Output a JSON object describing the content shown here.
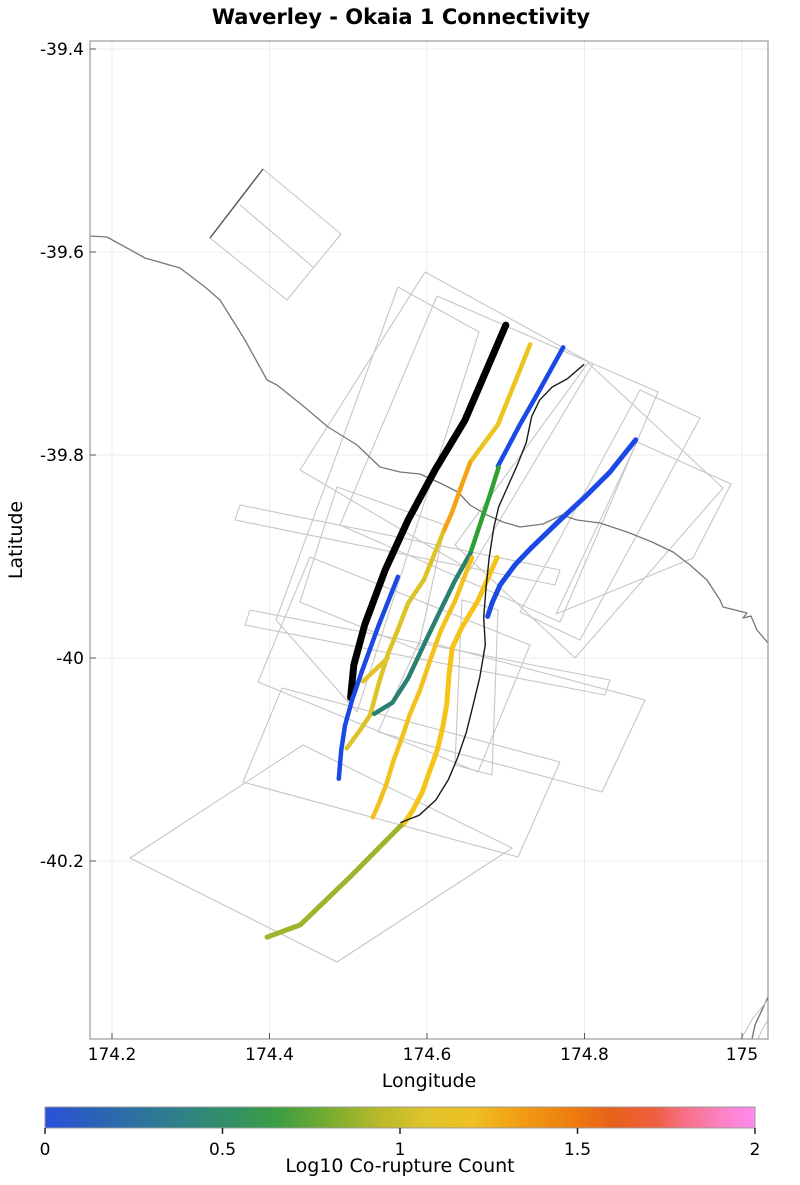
{
  "title": "Waverley - Okaia 1 Connectivity",
  "axes": {
    "x": {
      "label": "Longitude",
      "ticks": [
        {
          "label": "174.2",
          "lon": 174.2
        },
        {
          "label": "174.4",
          "lon": 174.4
        },
        {
          "label": "174.6",
          "lon": 174.6
        },
        {
          "label": "174.8",
          "lon": 174.8
        },
        {
          "label": "175",
          "lon": 175.0
        }
      ]
    },
    "y": {
      "label": "Latitude",
      "ticks": [
        {
          "label": "-39.4",
          "lat": -39.4
        },
        {
          "label": "-39.6",
          "lat": -39.6
        },
        {
          "label": "-39.8",
          "lat": -39.8
        },
        {
          "label": "-40",
          "lat": -40.0
        },
        {
          "label": "-40.2",
          "lat": -40.2
        }
      ]
    },
    "proj": {
      "lon0": 174.2,
      "x0": 112,
      "px_per_lon": 787.5,
      "lat0": -39.4,
      "y0": 49,
      "px_per_lat": 1015
    },
    "plot_box_px": {
      "left": 90,
      "top": 41,
      "right": 768,
      "bottom": 1039
    },
    "grid_color": "#ececec",
    "border_color": "#999999"
  },
  "colorbar": {
    "label": "Log10 Co-rupture Count",
    "bar_px": {
      "x": 45,
      "y": 1107,
      "w": 710,
      "h": 21
    },
    "ticks": [
      {
        "label": "0",
        "frac": 0
      },
      {
        "label": "0.5",
        "frac": 0.25
      },
      {
        "label": "1",
        "frac": 0.5
      },
      {
        "label": "1.5",
        "frac": 0.75
      },
      {
        "label": "2",
        "frac": 1
      }
    ],
    "stops": [
      [
        0,
        "#2b51dc"
      ],
      [
        0.06,
        "#2a5fbc"
      ],
      [
        0.13,
        "#2d72a0"
      ],
      [
        0.2,
        "#2f8384"
      ],
      [
        0.27,
        "#329261"
      ],
      [
        0.33,
        "#3e9e42"
      ],
      [
        0.4,
        "#77ac2f"
      ],
      [
        0.47,
        "#b8b92b"
      ],
      [
        0.54,
        "#e0c42b"
      ],
      [
        0.6,
        "#eec124"
      ],
      [
        0.67,
        "#f19d12"
      ],
      [
        0.74,
        "#ee7d0f"
      ],
      [
        0.8,
        "#e8611a"
      ],
      [
        0.86,
        "#ee5f41"
      ],
      [
        0.9,
        "#f76f85"
      ],
      [
        0.95,
        "#fc81c1"
      ],
      [
        1,
        "#fe8cf0"
      ]
    ]
  },
  "chart_data": {
    "type": "line",
    "subtype": "geographic fault connectivity map",
    "title": "Waverley - Okaia 1 Connectivity",
    "xlabel": "Longitude",
    "ylabel": "Latitude",
    "xlim": [
      174.172,
      175.042
    ],
    "ylim": [
      -40.375,
      -39.391
    ],
    "grid": true,
    "legend": "horizontal colorbar, Log10 Co-rupture Count, range 0 to 2",
    "traces": [
      {
        "name": "main-fault-black",
        "color": "#000000",
        "width": 7,
        "log10_est": null,
        "points": [
          [
            174.7,
            -39.672
          ],
          [
            174.648,
            -39.766
          ],
          [
            174.61,
            -39.815
          ],
          [
            174.576,
            -39.864
          ],
          [
            174.547,
            -39.913
          ],
          [
            174.521,
            -39.967
          ],
          [
            174.507,
            -40.007
          ],
          [
            174.503,
            -40.039
          ]
        ]
      },
      {
        "name": "gold-upper",
        "color": "#ecc41e",
        "width": 4.5,
        "log10_est": 0.9,
        "points": [
          [
            174.731,
            -39.691
          ],
          [
            174.69,
            -39.77
          ],
          [
            174.655,
            -39.807
          ]
        ]
      },
      {
        "name": "orange-mid",
        "color": "#f4a315",
        "width": 4.5,
        "log10_est": 1.15,
        "points": [
          [
            174.655,
            -39.807
          ],
          [
            174.642,
            -39.834
          ],
          [
            174.632,
            -39.856
          ],
          [
            174.62,
            -39.877
          ]
        ]
      },
      {
        "name": "yellow-lower",
        "color": "#ddc228",
        "width": 4.5,
        "log10_est": 0.85,
        "points": [
          [
            174.62,
            -39.877
          ],
          [
            174.596,
            -39.923
          ],
          [
            174.576,
            -39.946
          ],
          [
            174.563,
            -39.972
          ],
          [
            174.55,
            -39.997
          ],
          [
            174.538,
            -40.027
          ],
          [
            174.528,
            -40.056
          ],
          [
            174.515,
            -40.071
          ],
          [
            174.498,
            -40.089
          ]
        ]
      },
      {
        "name": "blue-northeast",
        "color": "#1a49e6",
        "width": 4.5,
        "log10_est": 0.0,
        "points": [
          [
            174.773,
            -39.694
          ],
          [
            174.743,
            -39.736
          ],
          [
            174.718,
            -39.77
          ],
          [
            174.703,
            -39.792
          ],
          [
            174.69,
            -39.811
          ]
        ]
      },
      {
        "name": "green-mid",
        "color": "#2fa032",
        "width": 4.5,
        "log10_est": 0.45,
        "points": [
          [
            174.691,
            -39.812
          ],
          [
            174.68,
            -39.839
          ],
          [
            174.667,
            -39.869
          ],
          [
            174.655,
            -39.897
          ]
        ]
      },
      {
        "name": "teal-mid",
        "color": "#2a8070",
        "width": 4.5,
        "log10_est": 0.25,
        "points": [
          [
            174.655,
            -39.897
          ],
          [
            174.636,
            -39.923
          ],
          [
            174.614,
            -39.958
          ],
          [
            174.596,
            -39.987
          ],
          [
            174.576,
            -40.02
          ],
          [
            174.556,
            -40.044
          ],
          [
            174.533,
            -40.055
          ]
        ]
      },
      {
        "name": "blue-east",
        "color": "#1a49e6",
        "width": 5,
        "log10_est": 0.0,
        "points": [
          [
            174.865,
            -39.785
          ],
          [
            174.832,
            -39.817
          ],
          [
            174.801,
            -39.841
          ],
          [
            174.769,
            -39.864
          ],
          [
            174.733,
            -39.891
          ],
          [
            174.712,
            -39.908
          ],
          [
            174.693,
            -39.928
          ],
          [
            174.683,
            -39.945
          ],
          [
            174.677,
            -39.959
          ]
        ]
      },
      {
        "name": "blue-southwest",
        "color": "#1a49e6",
        "width": 4.5,
        "log10_est": 0.0,
        "points": [
          [
            174.563,
            -39.92
          ],
          [
            174.538,
            -39.969
          ],
          [
            174.517,
            -40.014
          ],
          [
            174.505,
            -40.041
          ],
          [
            174.496,
            -40.066
          ],
          [
            174.491,
            -40.091
          ],
          [
            174.488,
            -40.119
          ]
        ]
      },
      {
        "name": "yellow-short-dash",
        "color": "#e2c32a",
        "width": 4.5,
        "log10_est": 0.85,
        "points": [
          [
            174.55,
            -40.0
          ],
          [
            174.519,
            -40.023
          ]
        ]
      },
      {
        "name": "yellow-central",
        "color": "#f2c11c",
        "width": 4.5,
        "log10_est": 0.9,
        "points": [
          [
            174.657,
            -39.901
          ],
          [
            174.636,
            -39.943
          ],
          [
            174.617,
            -39.974
          ],
          [
            174.604,
            -40.002
          ],
          [
            174.591,
            -40.032
          ],
          [
            174.578,
            -40.056
          ],
          [
            174.568,
            -40.079
          ],
          [
            174.558,
            -40.1
          ],
          [
            174.548,
            -40.125
          ],
          [
            174.538,
            -40.145
          ],
          [
            174.531,
            -40.157
          ]
        ]
      },
      {
        "name": "yellow-east-long",
        "color": "#f6c318",
        "width": 5,
        "log10_est": 0.9,
        "points": [
          [
            174.689,
            -39.901
          ],
          [
            174.665,
            -39.943
          ],
          [
            174.644,
            -39.97
          ],
          [
            174.632,
            -39.99
          ],
          [
            174.628,
            -40.017
          ],
          [
            174.625,
            -40.046
          ],
          [
            174.62,
            -40.068
          ],
          [
            174.613,
            -40.091
          ],
          [
            174.604,
            -40.11
          ],
          [
            174.594,
            -40.132
          ],
          [
            174.582,
            -40.15
          ],
          [
            174.57,
            -40.164
          ]
        ]
      },
      {
        "name": "olive-southwest-diagonal",
        "color": "#9fb32c",
        "width": 5,
        "log10_est": 0.65,
        "points": [
          [
            174.567,
            -40.165
          ],
          [
            174.502,
            -40.216
          ],
          [
            174.439,
            -40.263
          ],
          [
            174.397,
            -40.275
          ]
        ]
      },
      {
        "name": "thin-black-fault",
        "color": "#1a1a1a",
        "width": 1.4,
        "log10_est": null,
        "points": [
          [
            174.799,
            -39.711
          ],
          [
            174.778,
            -39.725
          ],
          [
            174.759,
            -39.733
          ],
          [
            174.743,
            -39.746
          ],
          [
            174.733,
            -39.762
          ],
          [
            174.726,
            -39.788
          ],
          [
            174.714,
            -39.811
          ],
          [
            174.702,
            -39.832
          ],
          [
            174.691,
            -39.851
          ],
          [
            174.685,
            -39.871
          ],
          [
            174.679,
            -39.901
          ],
          [
            174.675,
            -39.93
          ],
          [
            174.672,
            -39.96
          ],
          [
            174.674,
            -39.987
          ],
          [
            174.667,
            -40.019
          ],
          [
            174.658,
            -40.048
          ],
          [
            174.65,
            -40.073
          ],
          [
            174.639,
            -40.098
          ],
          [
            174.627,
            -40.12
          ],
          [
            174.611,
            -40.14
          ],
          [
            174.59,
            -40.155
          ],
          [
            174.567,
            -40.162
          ]
        ]
      }
    ],
    "basemap": {
      "outline_color": "#c6c6c6",
      "coast_color": "#777777",
      "coastline_px": [
        [
          90,
          236
        ],
        [
          107,
          237
        ],
        [
          145,
          258
        ],
        [
          180,
          268
        ],
        [
          205,
          287
        ],
        [
          220,
          300
        ],
        [
          245,
          340
        ],
        [
          267,
          380
        ],
        [
          277,
          385
        ],
        [
          302,
          405
        ],
        [
          328,
          427
        ],
        [
          357,
          445
        ],
        [
          380,
          467
        ],
        [
          400,
          472
        ],
        [
          420,
          474
        ],
        [
          440,
          483
        ],
        [
          458,
          492
        ],
        [
          470,
          505
        ],
        [
          487,
          515
        ],
        [
          503,
          522
        ],
        [
          520,
          527
        ],
        [
          543,
          524
        ],
        [
          562,
          515
        ],
        [
          577,
          520
        ],
        [
          600,
          523
        ],
        [
          627,
          532
        ],
        [
          652,
          542
        ],
        [
          673,
          552
        ],
        [
          690,
          565
        ],
        [
          707,
          580
        ],
        [
          720,
          600
        ],
        [
          723,
          607
        ],
        [
          747,
          613
        ],
        [
          743,
          618
        ],
        [
          751,
          616
        ],
        [
          757,
          630
        ],
        [
          768,
          643
        ]
      ],
      "fault_outline_polygons_px": [
        [
          [
            263,
            169
          ],
          [
            341,
            234
          ],
          [
            287,
            300
          ],
          [
            210,
            238
          ]
        ],
        [
          [
            398,
            287
          ],
          [
            479,
            332
          ],
          [
            357,
            712
          ],
          [
            276,
            620
          ]
        ],
        [
          [
            425,
            272
          ],
          [
            593,
            364
          ],
          [
            470,
            570
          ],
          [
            300,
            470
          ]
        ],
        [
          [
            437,
            296
          ],
          [
            658,
            392
          ],
          [
            560,
            622
          ],
          [
            340,
            525
          ]
        ],
        [
          [
            588,
            363
          ],
          [
            723,
            488
          ],
          [
            575,
            658
          ],
          [
            455,
            545
          ]
        ],
        [
          [
            637,
            442
          ],
          [
            731,
            484
          ],
          [
            693,
            558
          ],
          [
            556,
            614
          ]
        ],
        [
          [
            337,
            487
          ],
          [
            445,
            525
          ],
          [
            418,
            650
          ],
          [
            300,
            602
          ]
        ],
        [
          [
            310,
            557
          ],
          [
            530,
            645
          ],
          [
            478,
            772
          ],
          [
            258,
            682
          ]
        ],
        [
          [
            130,
            858
          ],
          [
            303,
            745
          ],
          [
            512,
            848
          ],
          [
            337,
            962
          ]
        ],
        [
          [
            282,
            688
          ],
          [
            560,
            762
          ],
          [
            518,
            857
          ],
          [
            243,
            782
          ]
        ],
        [
          [
            420,
            640
          ],
          [
            645,
            700
          ],
          [
            602,
            792
          ],
          [
            378,
            732
          ]
        ],
        [
          [
            462,
            600
          ],
          [
            498,
            610
          ],
          [
            492,
            775
          ],
          [
            455,
            765
          ]
        ],
        [
          [
            640,
            390
          ],
          [
            700,
            418
          ],
          [
            580,
            640
          ],
          [
            520,
            612
          ]
        ],
        [
          [
            240,
            505
          ],
          [
            560,
            570
          ],
          [
            555,
            585
          ],
          [
            235,
            520
          ]
        ],
        [
          [
            250,
            610
          ],
          [
            610,
            680
          ],
          [
            605,
            695
          ],
          [
            245,
            625
          ]
        ]
      ],
      "extra_lines_px": [
        {
          "name": "nw-rect-divider",
          "color": "#c6c6c6",
          "width": 1.1,
          "points": [
            [
              240,
              205
            ],
            [
              313,
              267
            ]
          ]
        },
        {
          "name": "nw-rect-dark-trace",
          "color": "#555555",
          "width": 1.4,
          "points": [
            [
              263,
              169
            ],
            [
              210,
              238
            ]
          ]
        },
        {
          "name": "corner-coast-dark",
          "color": "#777777",
          "width": 1.4,
          "points": [
            [
              768,
              997
            ],
            [
              761,
              1012
            ],
            [
              755,
              1025
            ],
            [
              752,
              1039
            ]
          ]
        },
        {
          "name": "corner-coast-light-1",
          "color": "#c6c6c6",
          "width": 1.1,
          "points": [
            [
              741,
              1039
            ],
            [
              753,
              1018
            ],
            [
              767,
              1001
            ]
          ]
        },
        {
          "name": "corner-coast-light-2",
          "color": "#c6c6c6",
          "width": 1.1,
          "points": [
            [
              768,
              1020
            ],
            [
              762,
              1030
            ],
            [
              758,
              1039
            ]
          ]
        }
      ]
    }
  }
}
